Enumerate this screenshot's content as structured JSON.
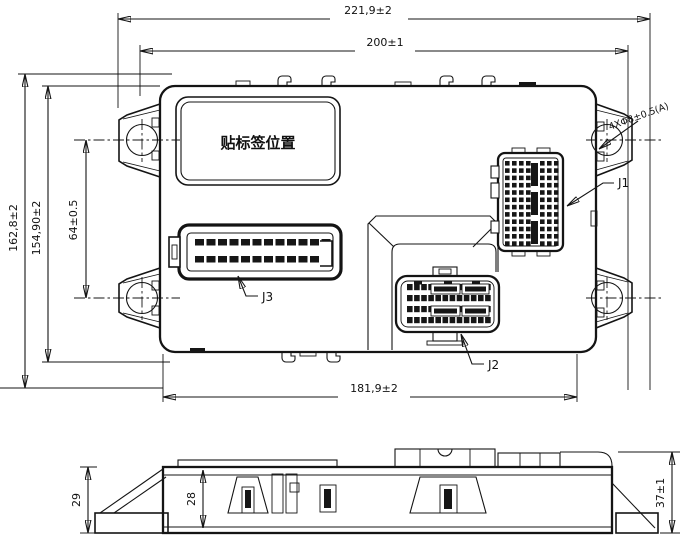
{
  "drawing": {
    "main_view": {
      "label_plate_text": "贴标签位置",
      "hole_note": "4XΦ8±0.5(A)",
      "connector_labels": {
        "j1": "J1",
        "j2": "J2",
        "j3": "J3"
      },
      "dimensions": {
        "overall_width": "221,9±2",
        "inner_width": "200±1",
        "overall_height": "162,8±2",
        "body_height": "154,90±2",
        "hole_spacing": "64±0.5",
        "bottom_width": "181,9±2"
      }
    },
    "side_view": {
      "dimensions": {
        "bracket_height": "29",
        "body_height": "28",
        "overall_height": "37±1"
      }
    },
    "line_color": "#141414",
    "background_color": "#ffffff"
  },
  "connector_specs": {
    "j3": {
      "rows": 2,
      "cols": 12,
      "x": 195,
      "y": 239,
      "dx": 11.5,
      "dy": 17,
      "w": 9,
      "h": 6.5
    },
    "j2": {
      "rows": 4,
      "cols": 12,
      "x": 407,
      "y": 284,
      "dx": 7.1,
      "dy": 11,
      "w": 5.6,
      "h": 6.2
    },
    "j1": {
      "rows": 12,
      "colsX": [
        505,
        512,
        519,
        526,
        540,
        547,
        554
      ],
      "y": 161,
      "dy": 7.3,
      "w": 4.6,
      "h": 4.6
    }
  }
}
